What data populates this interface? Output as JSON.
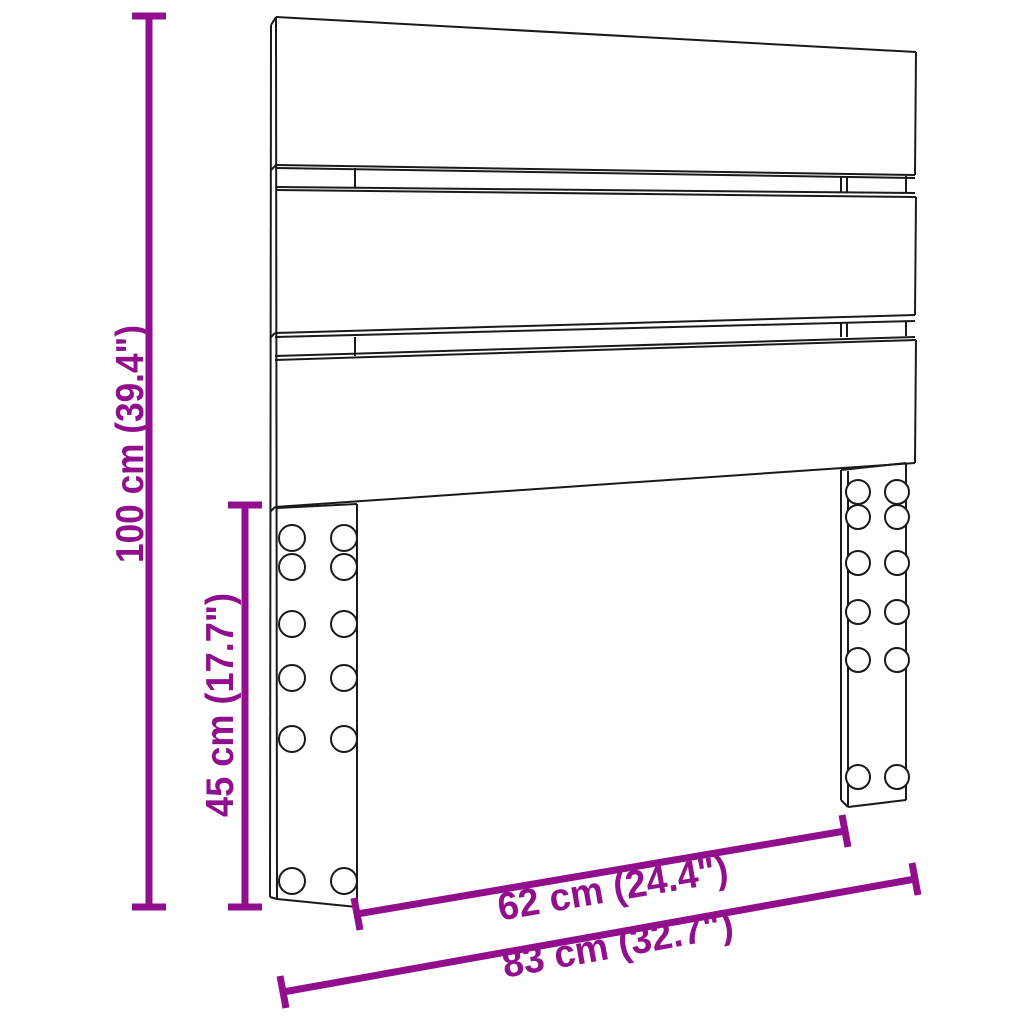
{
  "diagram": {
    "subject": "headboard-dimension-diagram",
    "dimensions": {
      "total_height": {
        "label": "100 cm (39.4\")",
        "cm": 100,
        "inches": 39.4
      },
      "leg_height": {
        "label": "45 cm (17.7\")",
        "cm": 45,
        "inches": 17.7
      },
      "inner_width": {
        "label": "62 cm (24.4\")",
        "cm": 62,
        "inches": 24.4
      },
      "total_width": {
        "label": "83 cm (32.7\")",
        "cm": 83,
        "inches": 32.7
      }
    },
    "colors": {
      "dimension": "#910E8C",
      "line": "#1A1A1A",
      "background": "#FFFFFF"
    }
  }
}
